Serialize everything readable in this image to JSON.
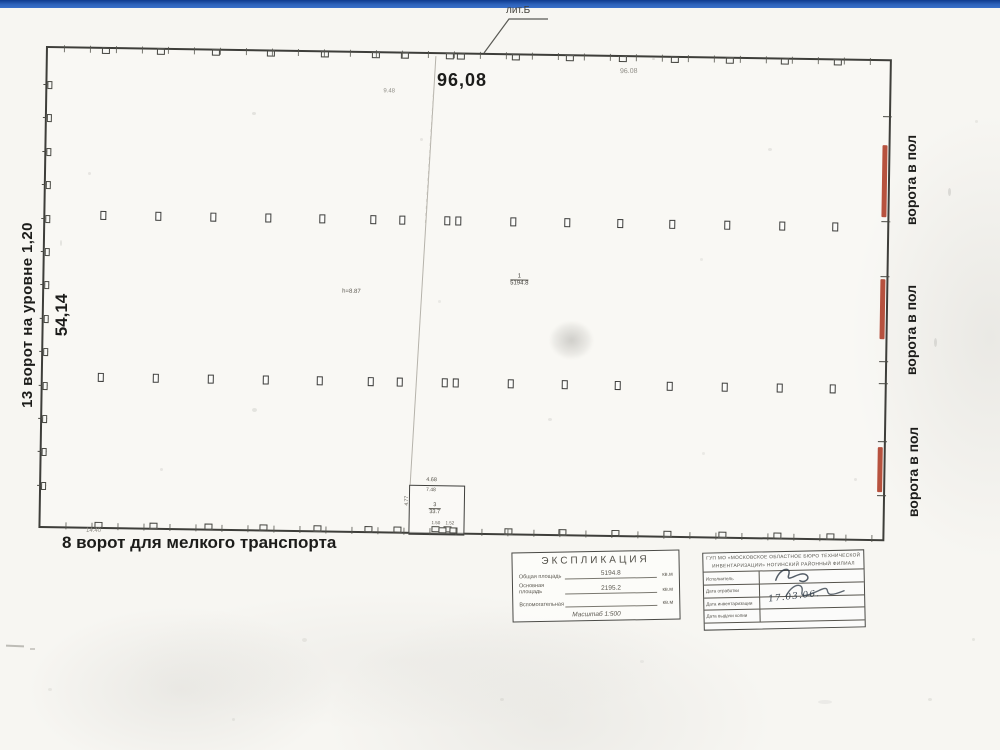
{
  "page": {
    "top_bar_color": "#2b5fb4"
  },
  "plan": {
    "building_label": "лит.Б",
    "dim_top": "96,08",
    "dim_top_faint": "96.08",
    "note_top": "9.48",
    "dim_left": "54,14",
    "label_left_gates": "13 ворот на уровне 1,20",
    "label_bottom_gates": "8 ворот для мелкого транспорта",
    "label_floor_gate": "ворота в пол",
    "dim_bottom_small": "14.40",
    "height_note": "h=8.87",
    "room_main": {
      "num": "1",
      "area": "5194.8"
    },
    "annex": {
      "dim_top": "4.68",
      "dim_top2": "7.48",
      "dim_left": "4.77",
      "num": "3",
      "area": "33.7",
      "dim_b1": "1.50",
      "dim_b2": "1.52"
    },
    "geometry": {
      "columns_x": [
        57,
        112,
        167,
        222,
        276,
        327,
        356,
        401,
        412,
        467,
        521,
        574,
        626,
        681,
        736,
        789
      ],
      "column_rows_y": [
        162,
        324
      ],
      "left_gate_count": 13,
      "right_ticks_y": [
        55,
        160,
        215,
        300,
        322,
        380,
        434
      ],
      "red_bars": [
        {
          "y": 84,
          "h": 72
        },
        {
          "y": 218,
          "h": 60
        },
        {
          "y": 386,
          "h": 45
        }
      ],
      "red_color": "#ad3a24"
    }
  },
  "explication": {
    "title": "ЭКСПЛИКАЦИЯ",
    "rows": [
      {
        "label": "Общая площадь",
        "value": "5194.8",
        "unit": "кв.м"
      },
      {
        "label": "Основная площадь",
        "value": "2195.2",
        "unit": "кв.м"
      },
      {
        "label": "Вспомогательная",
        "value": "",
        "unit": "кв.м"
      }
    ],
    "scale_note": "Масштаб 1:500"
  },
  "stamp": {
    "org_line1": "ГУП МО «МОСКОВСКОЕ ОБЛАСТНОЕ БЮРО ТЕХНИЧЕСКОЙ",
    "org_line2": "ИНВЕНТАРИЗАЦИИ» НОГИНСКИЙ РАЙОННЫЙ ФИЛИАЛ",
    "rows": [
      {
        "label": "Исполнитель"
      },
      {
        "label": "Дата отработки"
      },
      {
        "label": "Дата инвентаризации"
      },
      {
        "label": "Дата выдачи копии"
      }
    ],
    "date_note": "17.03.06."
  }
}
